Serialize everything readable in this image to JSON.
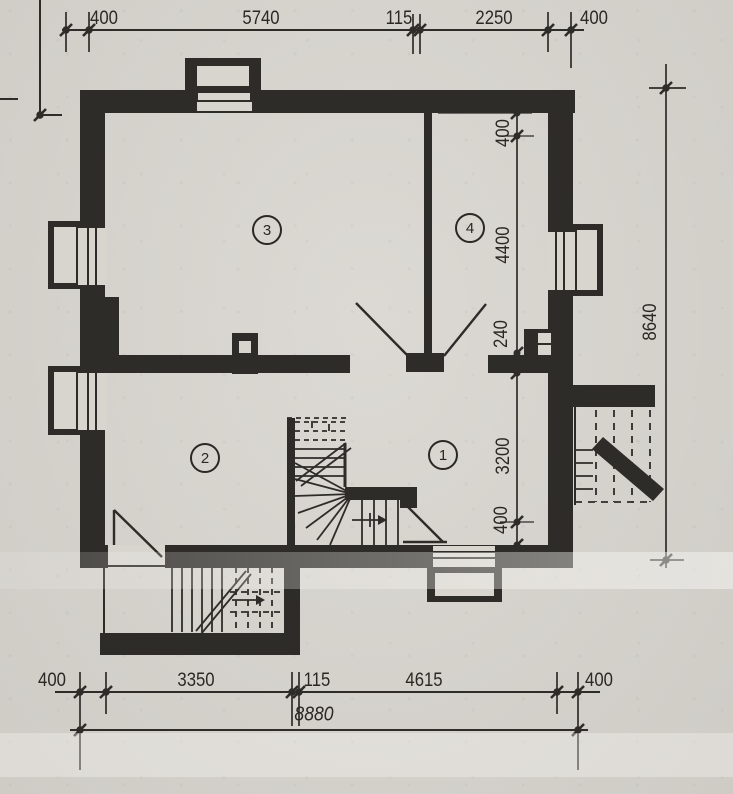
{
  "drawing": {
    "kind": "architectural-floor-plan",
    "ink_color": "#2e2c29",
    "paper_color": "#d8d5cf",
    "rooms": [
      {
        "number": "1"
      },
      {
        "number": "2"
      },
      {
        "number": "3"
      },
      {
        "number": "4"
      }
    ],
    "dimensions": {
      "top": [
        "400",
        "5740",
        "115",
        "2250",
        "400"
      ],
      "bottom": [
        "400",
        "3350",
        "115",
        "4615",
        "400"
      ],
      "bottom_total": "8880",
      "right_inner": [
        "400",
        "4400",
        "240",
        "3200",
        "400"
      ],
      "right_outer": "8640"
    }
  }
}
